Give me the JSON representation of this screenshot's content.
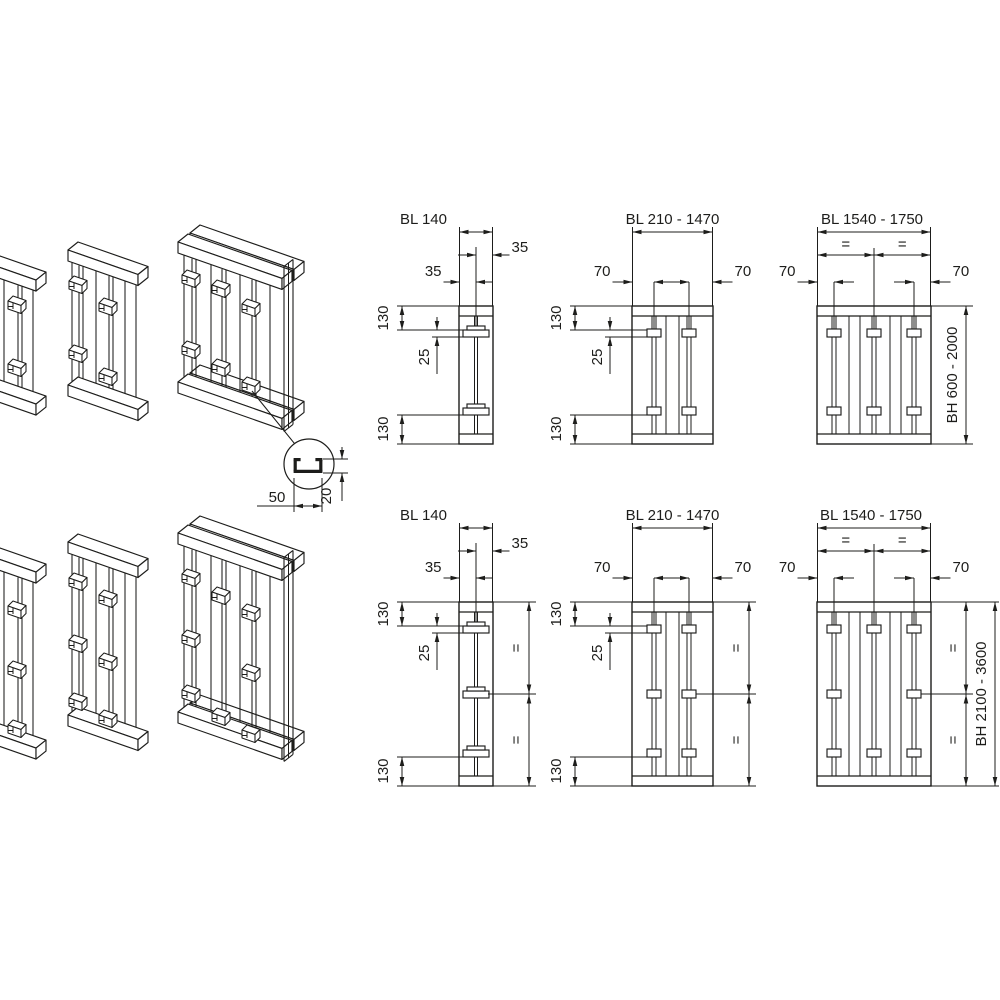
{
  "colors": {
    "line": "#1d1d1b",
    "background": "#ffffff"
  },
  "profile_detail": {
    "width": "50",
    "height": "20"
  },
  "top_row": {
    "panel_small": {
      "width_label": "BL 140",
      "offset_left": "35",
      "offset_right": "35",
      "dim_top": "130",
      "dim_slot": "25",
      "dim_bottom": "130"
    },
    "panel_medium": {
      "width_label": "BL 210 - 1470",
      "offset_left": "70",
      "offset_right": "70",
      "dim_top": "130",
      "dim_slot": "25",
      "dim_bottom": "130"
    },
    "panel_large": {
      "width_label": "BL 1540 -  1750",
      "offset_left": "70",
      "offset_right": "70",
      "equal_left": "=",
      "equal_right": "=",
      "height_label": "BH 600 - 2000"
    }
  },
  "bottom_row": {
    "panel_small": {
      "width_label": "BL 140",
      "offset_left": "35",
      "offset_right": "35",
      "dim_top": "130",
      "dim_slot": "25",
      "dim_bottom": "130",
      "equal_upper": "=",
      "equal_lower": "="
    },
    "panel_medium": {
      "width_label": "BL 210 - 1470",
      "offset_left": "70",
      "offset_right": "70",
      "dim_top": "130",
      "dim_slot": "25",
      "dim_bottom": "130",
      "equal_upper": "=",
      "equal_lower": "="
    },
    "panel_large": {
      "width_label": "BL 1540 -  1750",
      "offset_left": "70",
      "offset_right": "70",
      "equal_left": "=",
      "equal_right": "=",
      "equal_upper": "=",
      "equal_lower": "=",
      "height_label": "BH 2100 - 3600"
    }
  }
}
